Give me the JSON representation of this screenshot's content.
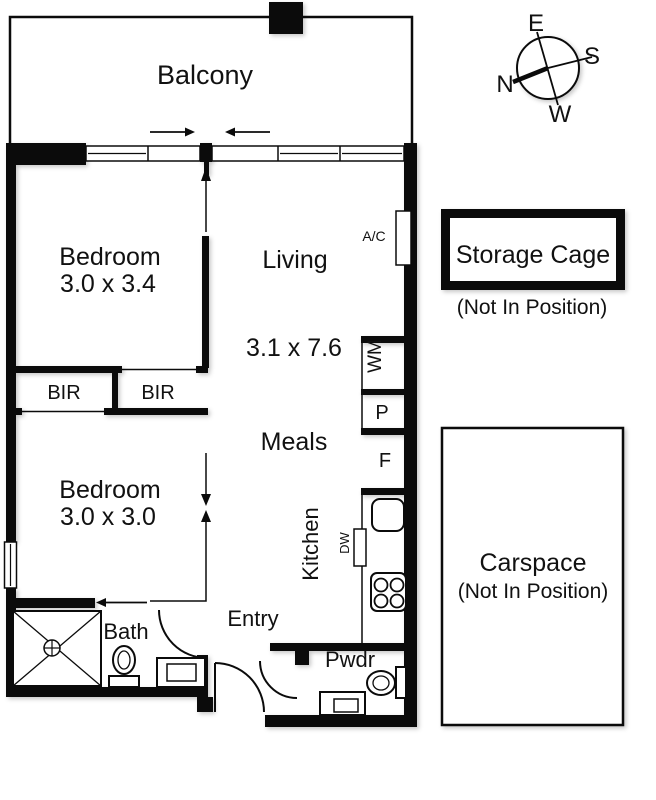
{
  "plan": {
    "rooms": {
      "balcony": {
        "label": "Balcony"
      },
      "bedroom1": {
        "label": "Bedroom",
        "dims": "3.0 x 3.4"
      },
      "living": {
        "label": "Living",
        "dims": "3.1 x 7.6"
      },
      "meals": {
        "label": "Meals"
      },
      "bedroom2": {
        "label": "Bedroom",
        "dims": "3.0 x 3.0"
      },
      "bir_left": {
        "label": "BIR"
      },
      "bir_right": {
        "label": "BIR"
      },
      "bath": {
        "label": "Bath"
      },
      "entry": {
        "label": "Entry"
      },
      "kitchen": {
        "label": "Kitchen"
      },
      "pwdr": {
        "label": "Pwdr"
      }
    },
    "fixtures": {
      "ac": "A/C",
      "wm": "WM",
      "pantry": "P",
      "fridge": "F",
      "dw": "DW"
    }
  },
  "compass": {
    "east": "E",
    "south": "S",
    "north": "N",
    "west": "W"
  },
  "storage_cage": {
    "label": "Storage Cage",
    "note": "(Not In Position)"
  },
  "carspace": {
    "label": "Carspace",
    "note": "(Not In Position)"
  },
  "colors": {
    "wall": "#0b0b0b",
    "background": "#ffffff"
  }
}
